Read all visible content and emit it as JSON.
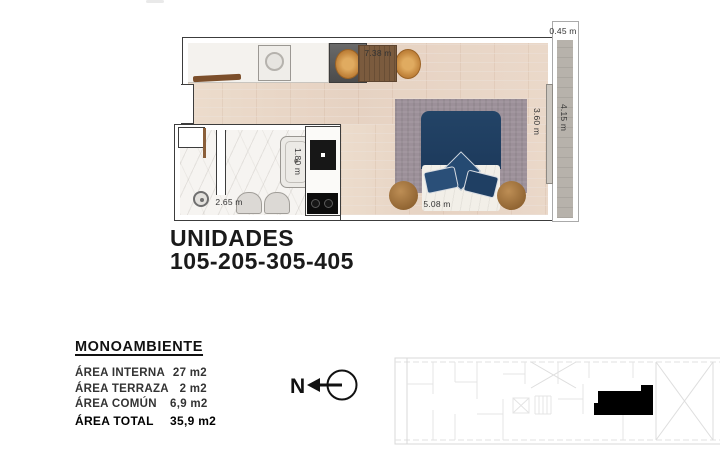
{
  "plan": {
    "dims": {
      "living_width": "7.38 m",
      "terrace_width": "0.45 m",
      "room_depth": "3.60 m",
      "terrace_length": "4.15 m",
      "bed_wall": "5.08 m",
      "bath_width": "2.65 m",
      "bath_depth": "1.80 m"
    }
  },
  "units": {
    "title": "UNIDADES",
    "numbers": "105-205-305-405"
  },
  "summary": {
    "type_name": "MONOAMBIENTE",
    "rows": [
      {
        "label": "ÁREA INTERNA",
        "value": "27 m2"
      },
      {
        "label": "ÁREA TERRAZA",
        "value": "2 m2"
      },
      {
        "label": "ÁREA COMÚN",
        "value": "6,9 m2"
      },
      {
        "label": "ÁREA TOTAL",
        "value": "35,9 m2"
      }
    ]
  },
  "compass": {
    "label": "N"
  },
  "colors": {
    "wood_floor": "#e9d7c8",
    "marble": "#f6f4f1",
    "terrace_gray": "#b7b2ab",
    "bed_navy": "#1d3a5c",
    "chair_orange": "#c5883f",
    "rug_mauve": "#9c9099",
    "wall_outline": "#3c3c3c",
    "keyplan_line": "#d8d8d8",
    "unit_highlight": "#000000"
  }
}
